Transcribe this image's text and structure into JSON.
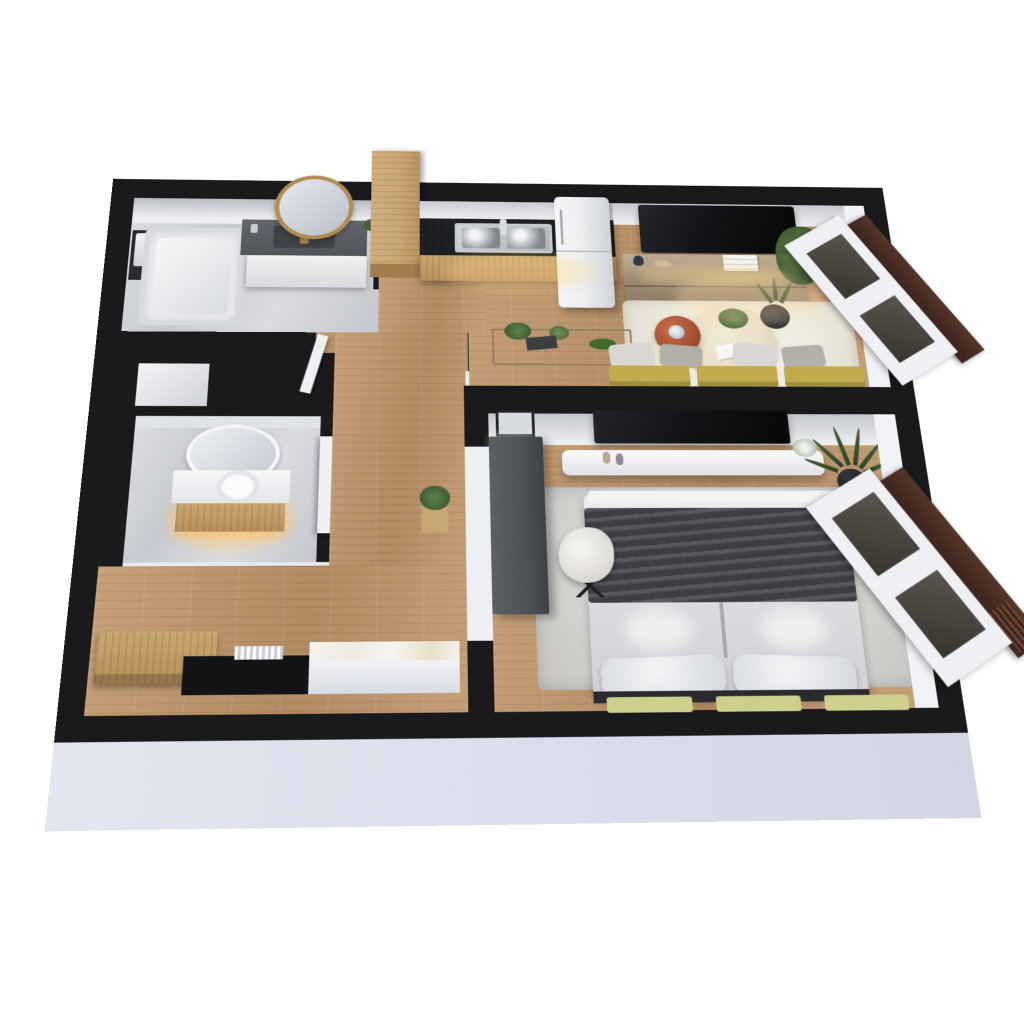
{
  "scene": {
    "kind": "3d-floor-plan-render",
    "view": "dollhouse-top-down-perspective",
    "background": "#ffffff",
    "text_on_image": "none"
  },
  "colors": {
    "wall_black": "#1a1a1c",
    "floor_oak": "#c6a078",
    "floor_oak_dark": "#b18a62",
    "marble_light": "#d6d8dc",
    "counter_black": "#1d1e21",
    "oak_cabinet": "#c8a672",
    "fridge_white": "#eceef0",
    "tv_black": "#141518",
    "sideboard_tan": "#ab987f",
    "rug_cream": "#edeade",
    "ottoman_cream": "#e8dec8",
    "copper": "#a14f31",
    "sofa_mustard": "#c2ab4d",
    "pillow_light": "#dad7d2",
    "pillow_dark": "#b3b0aa",
    "bed_white": "#dfe1e4",
    "throw_gray": "#4a4b51",
    "bench_yellow_green": "#ccd08c",
    "desk_charcoal": "#4e5357",
    "rug_gray": "#d8d7d4",
    "window_brown": "#402820",
    "frame_white": "#eef0f3",
    "plant_green": "#44623a",
    "pot_black": "#1f2022",
    "skirt_white": "#dce0ec",
    "glow_warm": "#ffc96e",
    "mirror_gold": "#b08d52"
  },
  "rooms": [
    {
      "id": "bathroom",
      "position": "top-left",
      "floor": "gray-marble",
      "furniture": [
        "bathtub",
        "towel-rack-with-towels",
        "dark-gray-vanity-gold-faucet",
        "white-vanity-cabinet",
        "round-gold-mirror",
        "small-plant"
      ]
    },
    {
      "id": "wc",
      "position": "middle-left",
      "floor": "gray-marble",
      "furniture": [
        "oval-white-mirror",
        "white-counter-round-vessel-sink",
        "oak-vanity-warm-light",
        "open-white-door"
      ]
    },
    {
      "id": "kitchen",
      "position": "top-middle",
      "floor": "oak-planks",
      "furniture": [
        "black-countertop",
        "stainless-double-sink",
        "oak-base-cabinets",
        "tall-oak-cabinet-column",
        "white-fridge"
      ]
    },
    {
      "id": "living-room",
      "position": "top-right",
      "floor": "oak-planks",
      "furniture": [
        "wall-mounted-tv",
        "tan-sideboard-with-decor",
        "white-books",
        "cream-area-rug",
        "round-cream-ottoman",
        "copper-side-table-lamp",
        "cream-pouf",
        "black-pot-plant",
        "tall-corner-plant",
        "mustard-sofa-gray-pillows",
        "console-table-with-plants",
        "window-dark-brown-frame"
      ]
    },
    {
      "id": "bedroom",
      "position": "bottom-right",
      "floor": "oak-planks",
      "furniture": [
        "wall-mounted-tv",
        "white-floating-console-vases",
        "gray-mottled-rug",
        "double-bed-white-duvet",
        "dark-gray-throw",
        "two-white-pillows",
        "three-yellow-green-bench-cushions",
        "charcoal-desk",
        "white-fluffy-desk-chair",
        "three-picture-frames",
        "palm-plant-black-pot",
        "window-dark-brown-frame"
      ]
    },
    {
      "id": "hallway-entry",
      "position": "bottom-left",
      "floor": "oak-planks",
      "furniture": [
        "oak-entry-bench",
        "black-doormat",
        "white-radiator",
        "marble-top-console",
        "plant-on-stool"
      ]
    }
  ],
  "structure": {
    "outer_walls": "thick-black",
    "inner_wall_faces": "white-gray",
    "front_skirt": "light-white-band",
    "windows_right_side": 2,
    "niche_shaft": "between-bathroom-and-wc"
  }
}
